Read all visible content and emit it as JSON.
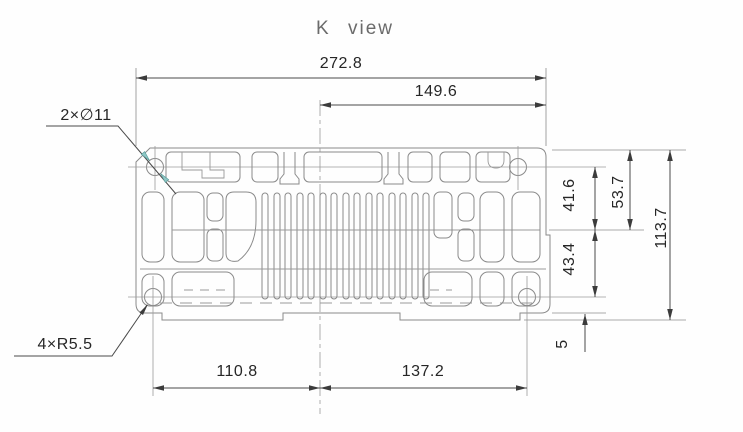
{
  "title": "K view",
  "drawing": {
    "view_label": "K view",
    "dimensions": {
      "overall_width": "272.8",
      "upper_right_width": "149.6",
      "lower_left_width": "110.8",
      "lower_right_width": "137.2",
      "right_upper_height": "41.6",
      "right_upper_total": "53.7",
      "right_lower_height": "43.4",
      "overall_height": "113.7",
      "base_step": "5"
    },
    "callouts": {
      "holes": "2×∅11",
      "corner_radius": "4×R5.5"
    },
    "colors": {
      "part_line": "#8a8a8a",
      "dimension_line": "#4a4a4a",
      "leader_arrow": "#8fc7c5",
      "text": "#262626",
      "title_text": "#6b6b6b",
      "background": "#fefefe"
    }
  }
}
